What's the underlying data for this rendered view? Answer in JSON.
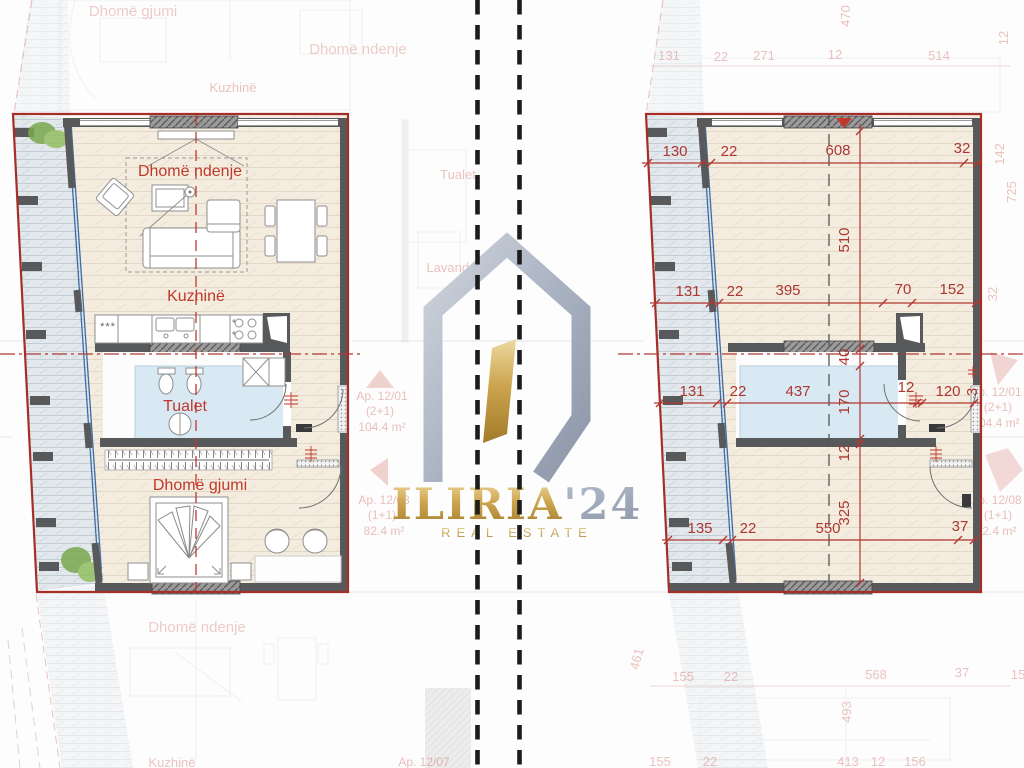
{
  "logo": {
    "name": "ILIRIA",
    "year": "'24",
    "tagline": "REAL ESTATE"
  },
  "left_plan": {
    "rooms": {
      "living": "Dhomë ndenje",
      "kitchen": "Kuzhinë",
      "bath": "Tualet",
      "bedroom": "Dhomë gjumi"
    },
    "tv_label": "TV 75\"",
    "hob_label": "***"
  },
  "right_plan": {
    "dims": {
      "top": [
        "130",
        "22",
        "608",
        "32"
      ],
      "mid": [
        "131",
        "22",
        "395",
        "70",
        "152"
      ],
      "lower": [
        "131",
        "22",
        "437",
        "12",
        "120",
        "3"
      ],
      "bottom": [
        "135",
        "22",
        "550",
        "37"
      ],
      "vertical": [
        "510",
        "40",
        "170",
        "12",
        "325"
      ]
    }
  },
  "background": {
    "room_labels": {
      "bedroom": "Dhomë gjumi",
      "living": "Dhomë ndenje",
      "kitchen": "Kuzhinë",
      "bath": "Tualet",
      "laundry": "Lavanderi"
    },
    "apartments": {
      "a1": {
        "id": "Ap. 12/01",
        "type": "(2+1)",
        "area": "104.4 m²"
      },
      "a2": {
        "id": "Ap. 12/08",
        "type": "(1+1)",
        "area": "82.4 m²"
      },
      "a3": {
        "id": "Ap. 12/07"
      }
    },
    "numbers": {
      "top": [
        "131",
        "22",
        "271",
        "12",
        "514",
        "470",
        "12"
      ],
      "right": [
        "142",
        "725",
        "32"
      ],
      "bottom": [
        "155",
        "22",
        "568",
        "37",
        "15",
        "493",
        "461"
      ],
      "bottom_edge": [
        "155",
        "22",
        "413",
        "12",
        "156"
      ]
    }
  },
  "colors": {
    "dimension_red": "#b23832",
    "wall_gray": "#57595b",
    "floor_beige": "#f3ecdf",
    "balcony_gray": "#e3e8ec",
    "bath_blue": "#d8e9f4",
    "logo_gold": "#cda44e",
    "logo_silver": "#aab3c2"
  }
}
